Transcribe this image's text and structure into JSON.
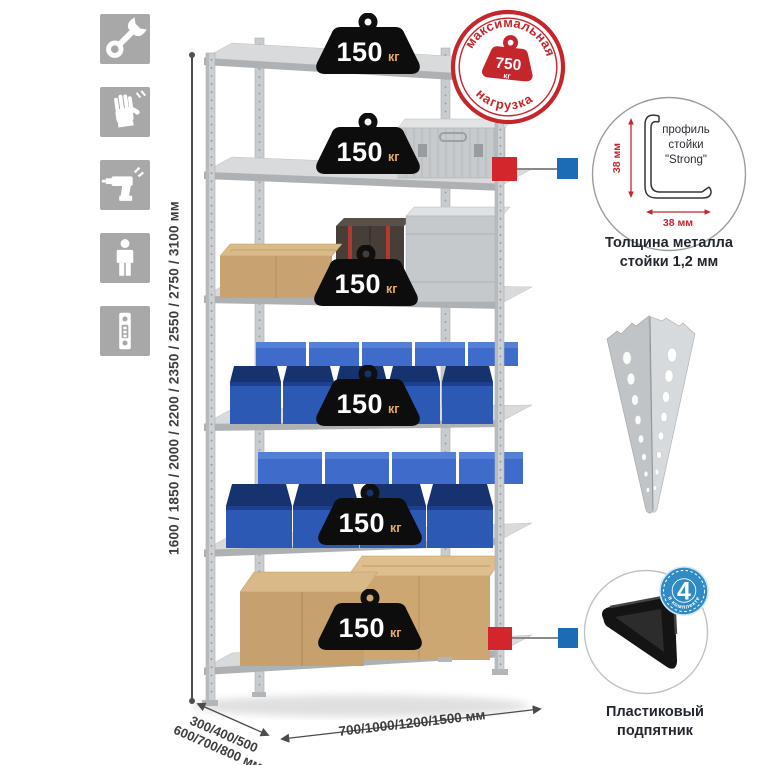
{
  "sidebar": {
    "icons": [
      "wrench-icon",
      "gloves-icon",
      "drill-icon",
      "person-icon",
      "profile-strip-icon"
    ]
  },
  "dimensions": {
    "height": "1600 / 1850 / 2000 / 2200 / 2350 / 2550 / 2750 / 3100 мм",
    "depth_line1": "300/400/500",
    "depth_line2": "600/700/800 мм",
    "width": "700/1000/1200/1500 мм"
  },
  "stamp": {
    "arc_top": "максимальная",
    "arc_bottom": "нагрузка",
    "value": "750",
    "unit": "кг"
  },
  "rack": {
    "shelf_count": 6,
    "badge_value": "150",
    "badge_unit": "кг"
  },
  "profile_detail": {
    "line1": "профиль",
    "line2": "стойки",
    "line3": "\"Strong\"",
    "dim_v": "38 мм",
    "dim_h": "38 мм",
    "caption1": "Толщина металла",
    "caption2": "стойки 1,2 мм"
  },
  "foot_detail": {
    "badge_value": "4",
    "badge_arc": "в комплекте",
    "caption1": "Пластиковый",
    "caption2": "подпятник"
  },
  "colors": {
    "accent_red": "#c4262c",
    "marker_red": "#d3262c",
    "marker_blue": "#1b6cb5",
    "bin_blue": "#2c59b4",
    "badge_blue": "#2f8bc5",
    "tile_gray": "#a8a8a8"
  }
}
